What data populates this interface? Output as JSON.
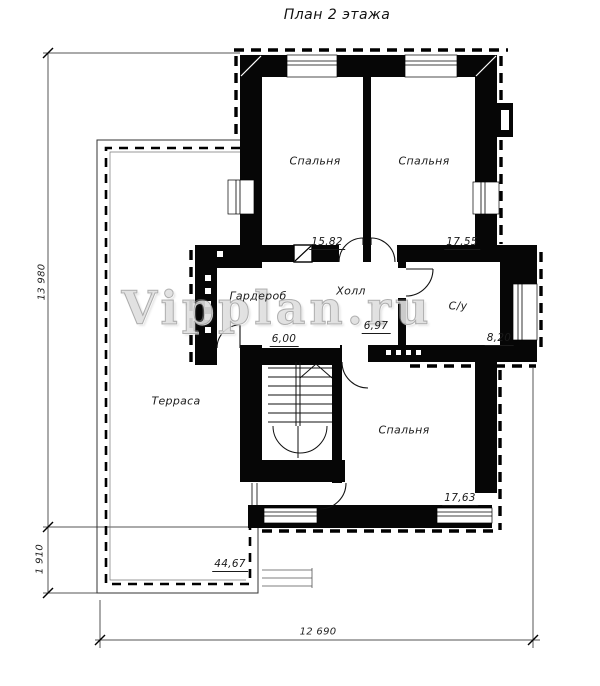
{
  "title": "План 2 этажа",
  "watermark": "Vipplan.ru",
  "rooms": {
    "bedroom_top_left": {
      "label": "Спальня",
      "area": "15,82"
    },
    "bedroom_top_right": {
      "label": "Спальня",
      "area": "17,55"
    },
    "wardrobe": {
      "label": "Гардероб",
      "area": "6,00"
    },
    "hall": {
      "label": "Холл",
      "area": "6,97"
    },
    "bathroom": {
      "label": "С/у",
      "area": "8,20"
    },
    "bedroom_bottom": {
      "label": "Спальня",
      "area": "17,63"
    },
    "terrace": {
      "label": "Терраса",
      "area": "44,67"
    }
  },
  "dimensions": {
    "left_total": "13 980",
    "left_lower": "1 910",
    "bottom_total": "12 690"
  }
}
